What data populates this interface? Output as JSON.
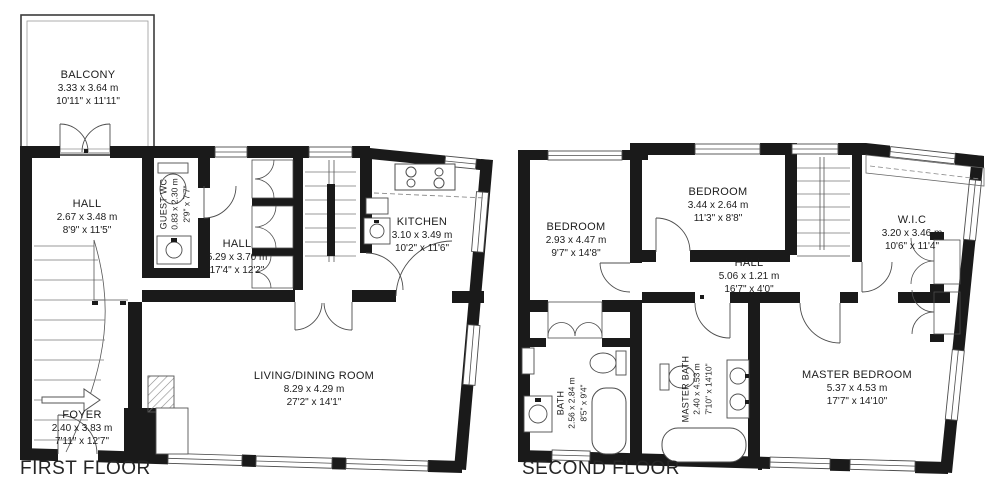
{
  "colors": {
    "wall": "#1a1a1a",
    "line": "#4d4d4d",
    "text": "#1c1c1c"
  },
  "floors": [
    {
      "title": "FIRST FLOOR",
      "rooms": [
        {
          "name": "BALCONY",
          "metric": "3.33 x 3.64 m",
          "imperial": "10'11\" x 11'11\""
        },
        {
          "name": "HALL",
          "metric": "2.67 x 3.48 m",
          "imperial": "8'9\" x 11'5\""
        },
        {
          "name": "GUEST WC",
          "metric": "0.83 x 2.30 m",
          "imperial": "2'9\" x 7'7\""
        },
        {
          "name": "HALL",
          "metric": "5.29 x 3.70 m",
          "imperial": "17'4\" x 12'2\""
        },
        {
          "name": "KITCHEN",
          "metric": "3.10 x 3.49 m",
          "imperial": "10'2\" x 11'6\""
        },
        {
          "name": "LIVING/DINING ROOM",
          "metric": "8.29 x 4.29 m",
          "imperial": "27'2\" x 14'1\""
        },
        {
          "name": "FOYER",
          "metric": "2.40 x 3.83 m",
          "imperial": "7'11\" x 12'7\""
        }
      ]
    },
    {
      "title": "SECOND FLOOR",
      "rooms": [
        {
          "name": "BEDROOM",
          "metric": "3.44 x 2.64 m",
          "imperial": "11'3\" x 8'8\""
        },
        {
          "name": "BEDROOM",
          "metric": "2.93 x 4.47 m",
          "imperial": "9'7\" x 14'8\""
        },
        {
          "name": "W.I.C",
          "metric": "3.20 x 3.46 m",
          "imperial": "10'6\" x 11'4\""
        },
        {
          "name": "HALL",
          "metric": "5.06 x 1.21 m",
          "imperial": "16'7\" x 4'0\""
        },
        {
          "name": "BATH",
          "metric": "2.56 x 2.84 m",
          "imperial": "8'5\" x 9'4\""
        },
        {
          "name": "MASTER BATH",
          "metric": "2.40 x 4.53 m",
          "imperial": "7'10\" x 14'10\""
        },
        {
          "name": "MASTER BEDROOM",
          "metric": "5.37 x 4.53 m",
          "imperial": "17'7\" x 14'10\""
        }
      ]
    }
  ]
}
